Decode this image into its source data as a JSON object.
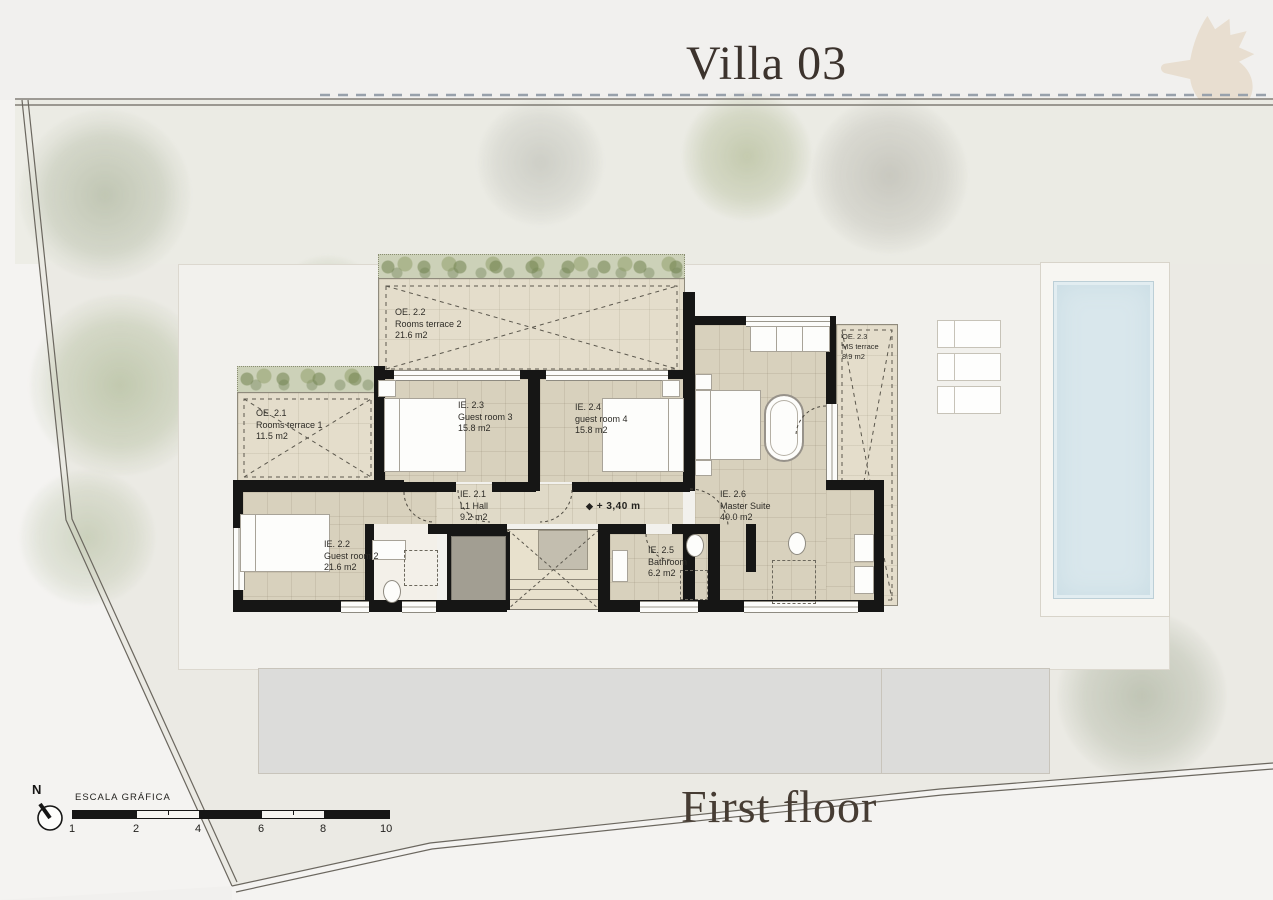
{
  "header": {
    "title": "Villa 03"
  },
  "footer": {
    "floor_label": "First floor"
  },
  "north": {
    "label": "N"
  },
  "scale_bar": {
    "title": "ESCALA GRÁFICA",
    "ticks": [
      "1",
      "2",
      "4",
      "6",
      "8",
      "10"
    ]
  },
  "level": {
    "symbol": "◆",
    "text": "+ 3,40 m"
  },
  "rooms": {
    "oe22": {
      "code": "OE. 2.2",
      "name": "Rooms terrace 2",
      "area": "21.6 m2"
    },
    "oe21": {
      "code": "OE. 2.1",
      "name": "Rooms terrace 1",
      "area": "11.5 m2"
    },
    "oe23": {
      "code": "OE. 2.3",
      "name": "MS terrace",
      "area": "8.9 m2"
    },
    "ie23": {
      "code": "IE. 2.3",
      "name": "Guest room 3",
      "area": "15.8 m2"
    },
    "ie24": {
      "code": "IE. 2.4",
      "name": "guest room 4",
      "area": "15.8 m2"
    },
    "ie21": {
      "code": "IE. 2.1",
      "name": "L1 Hall",
      "area": "9.2 m2"
    },
    "ie26": {
      "code": "IE. 2.6",
      "name": "Master Suite",
      "area": "40.0 m2"
    },
    "ie22": {
      "code": "IE. 2.2",
      "name": "Guest room 2",
      "area": "21.6 m2"
    },
    "ie25": {
      "code": "IE. 2.5",
      "name": "Bathroom",
      "area": "6.2 m2"
    }
  },
  "colors": {
    "wall": "#161615",
    "pool_water": "#d9e7ec",
    "room_tile": "#d8d1bd",
    "terrace_tile": "#e4ddcb",
    "tree_green": "#9fae85",
    "title_text": "#3c332d",
    "seahorse": "#e8ddcd"
  }
}
